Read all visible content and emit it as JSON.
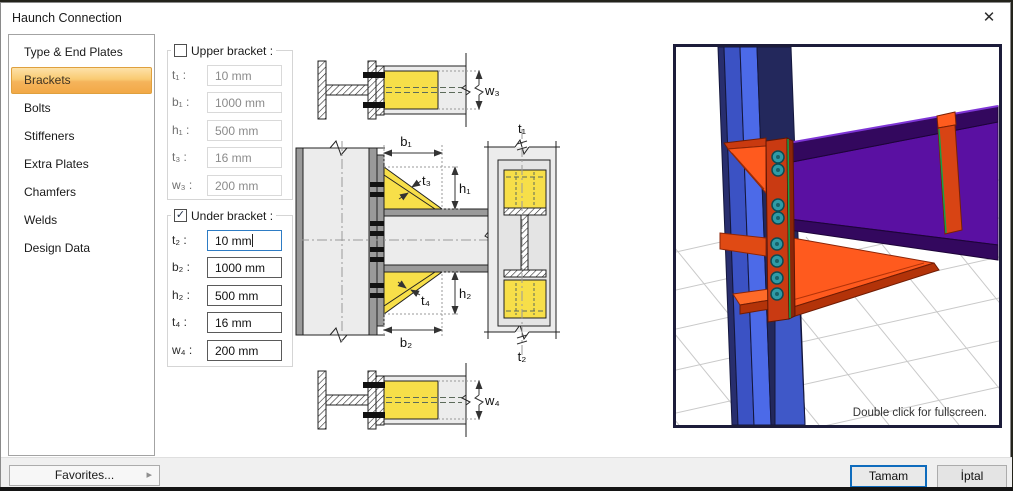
{
  "window": {
    "title": "Haunch Connection",
    "close_glyph": "✕"
  },
  "sidebar": {
    "selected": "Brackets",
    "items": [
      {
        "label": "Type & End Plates"
      },
      {
        "label": "Brackets"
      },
      {
        "label": "Bolts"
      },
      {
        "label": "Stiffeners"
      },
      {
        "label": "Extra Plates"
      },
      {
        "label": "Chamfers"
      },
      {
        "label": "Welds"
      },
      {
        "label": "Design Data"
      }
    ]
  },
  "upper_bracket": {
    "title": "Upper bracket :",
    "checked": false,
    "check_glyph": "",
    "fields": [
      {
        "label": "t₁ :",
        "value": "10 mm"
      },
      {
        "label": "b₁ :",
        "value": "1000 mm"
      },
      {
        "label": "h₁ :",
        "value": "500 mm"
      },
      {
        "label": "t₃ :",
        "value": "16 mm"
      },
      {
        "label": "w₃ :",
        "value": "200 mm"
      }
    ]
  },
  "under_bracket": {
    "title": "Under bracket :",
    "checked": true,
    "check_glyph": "✓",
    "fields": [
      {
        "label": "t₂ :",
        "value": "10 mm"
      },
      {
        "label": "b₂ :",
        "value": "1000 mm"
      },
      {
        "label": "h₂ :",
        "value": "500 mm"
      },
      {
        "label": "t₄ :",
        "value": "16 mm"
      },
      {
        "label": "w₄ :",
        "value": "200 mm"
      }
    ]
  },
  "diagram": {
    "labels": {
      "w3": "w₃",
      "b1": "b₁",
      "t3": "t₃",
      "h1": "h₁",
      "t1": "t₁",
      "t2": "t₂",
      "t4": "t₄",
      "h2": "h₂",
      "b2": "b₂",
      "w4": "w₄"
    }
  },
  "viewport": {
    "hint": "Double click for fullscreen."
  },
  "footer": {
    "favorites_label": "Favorites...",
    "favorites_arrow": "▸",
    "ok_label": "Tamam",
    "cancel_label": "İptal"
  },
  "colors": {
    "selected_item_orange": "#F5B45C",
    "focus_border_blue": "#2E7CC4",
    "bracket_yellow": "#F7DF49",
    "column_blue": "#3B52C4",
    "beam_purple": "#5A10A2",
    "plate_orange": "#C93A12",
    "bolt_teal": "#2F9BA6"
  }
}
